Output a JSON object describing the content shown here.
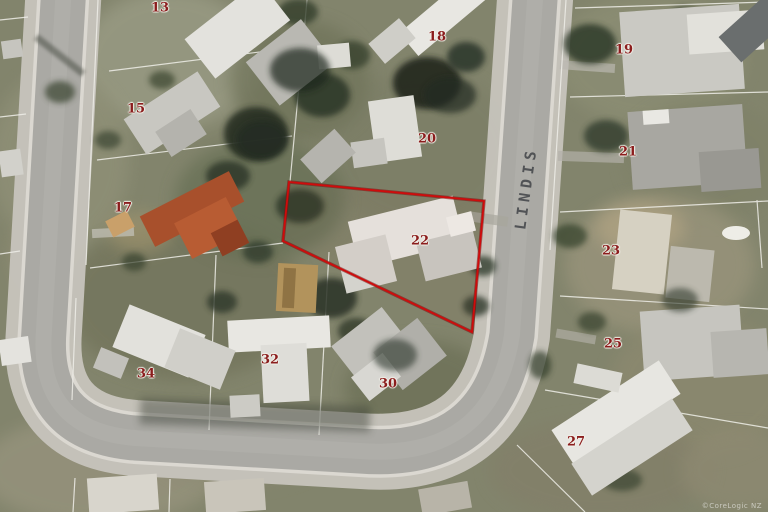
{
  "map": {
    "street": {
      "name": "LINDIS"
    },
    "watermark": "©CoreLogic NZ",
    "highlighted_parcel": {
      "number": "22",
      "outline_points": "289,182 484,201 472,332 283,241",
      "outline_color": "#cf0b0b"
    },
    "parcels": [
      {
        "number": "13",
        "x": 160,
        "y": 8
      },
      {
        "number": "15",
        "x": 136,
        "y": 109
      },
      {
        "number": "17",
        "x": 123,
        "y": 208
      },
      {
        "number": "18",
        "x": 437,
        "y": 37
      },
      {
        "number": "19",
        "x": 624,
        "y": 50
      },
      {
        "number": "20",
        "x": 427,
        "y": 139
      },
      {
        "number": "21",
        "x": 628,
        "y": 152
      },
      {
        "number": "22",
        "x": 420,
        "y": 241,
        "highlighted": true
      },
      {
        "number": "23",
        "x": 611,
        "y": 251
      },
      {
        "number": "25",
        "x": 613,
        "y": 344
      },
      {
        "number": "27",
        "x": 576,
        "y": 442
      },
      {
        "number": "30",
        "x": 388,
        "y": 384
      },
      {
        "number": "32",
        "x": 270,
        "y": 360
      },
      {
        "number": "34",
        "x": 146,
        "y": 374
      }
    ],
    "colors": {
      "parcel_label": "#8b1d1d",
      "street_label": "#45474b",
      "parcel_outline": "#cf0b0b"
    }
  }
}
